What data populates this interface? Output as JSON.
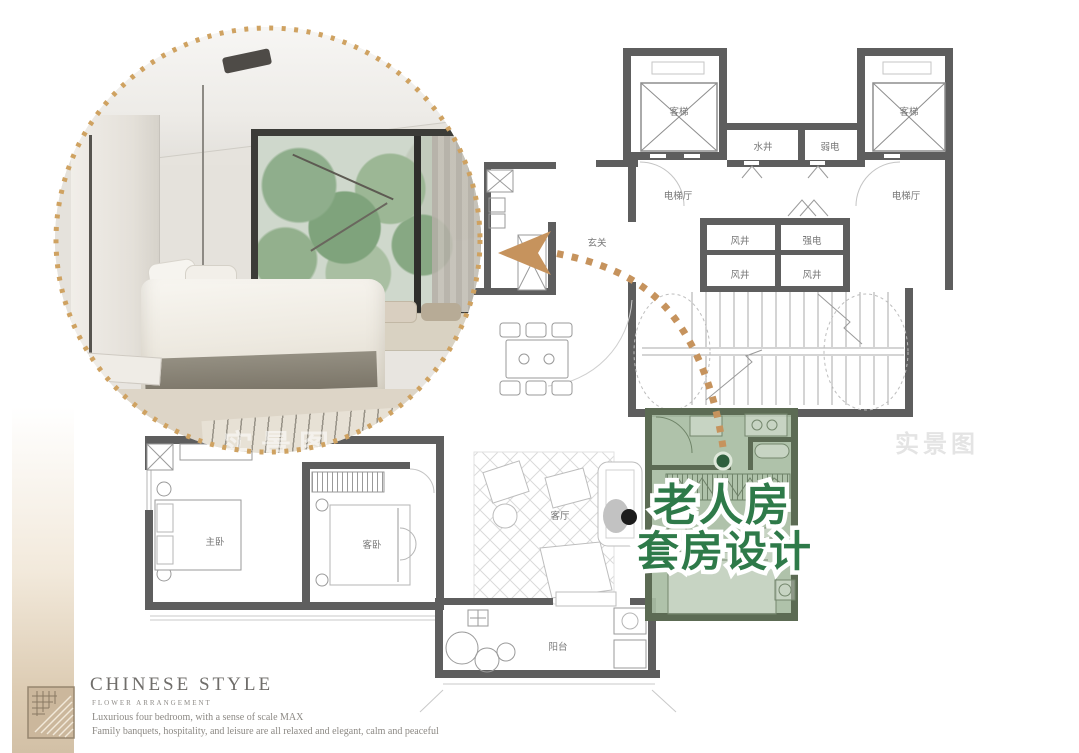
{
  "photo": {
    "watermark": "实景图"
  },
  "callout": {
    "line1": "老人房",
    "line2": "套房设计"
  },
  "floorplan": {
    "watermark": "实景图",
    "labels": {
      "elevator_left": "客梯",
      "elevator_right": "客梯",
      "water_shaft": "水井",
      "weak_electric": "弱电",
      "lobby_left": "电梯厅",
      "lobby_right": "电梯厅",
      "air_shaft_top": "风井",
      "strong_electric": "强电",
      "air_shaft_bottom_left": "风井",
      "air_shaft_bottom_right": "风井",
      "foyer": "玄关",
      "master_bedroom": "主卧",
      "guest_bedroom": "客卧",
      "living_room": "客厅",
      "balcony": "阳台"
    }
  },
  "footer": {
    "title": "CHINESE STYLE",
    "subtitle": "FLOWER ARRANGEMENT",
    "line1": "Luxurious four bedroom, with a sense of scale MAX",
    "line2": "Family banquets, hospitality, and leisure are all relaxed and elegant, calm and peaceful"
  },
  "colors": {
    "accent_tan": "#c6935d",
    "suite_green": "#a8bda3",
    "callout_green": "#2e7a49",
    "wall_gray": "#5e5e5e"
  }
}
